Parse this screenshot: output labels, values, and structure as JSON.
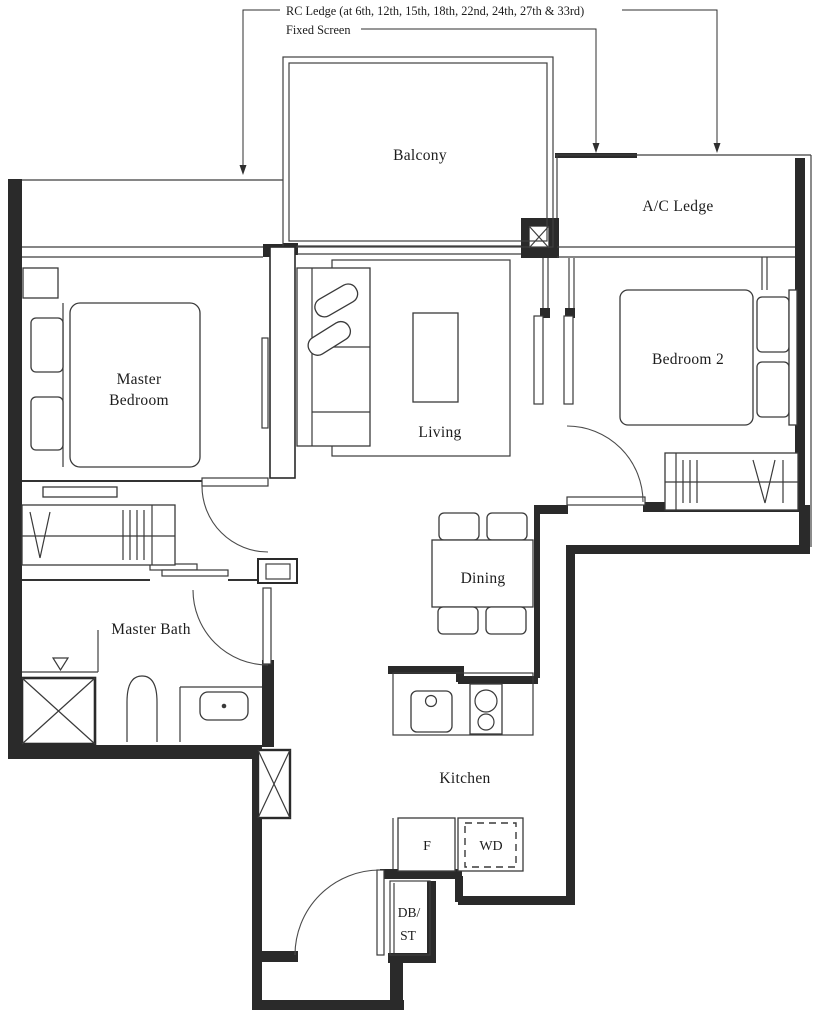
{
  "annotations": {
    "rc_ledge": "RC Ledge (at 6th, 12th, 15th, 18th, 22nd, 24th, 27th & 33rd)",
    "fixed_screen": "Fixed Screen"
  },
  "rooms": {
    "balcony": "Balcony",
    "ac_ledge": "A/C Ledge",
    "master_bedroom_line1": "Master",
    "master_bedroom_line2": "Bedroom",
    "living": "Living",
    "bedroom2": "Bedroom 2",
    "dining": "Dining",
    "master_bath": "Master Bath",
    "kitchen": "Kitchen"
  },
  "fixtures": {
    "fridge": "F",
    "washer_dryer": "WD",
    "db_st_line1": "DB/",
    "db_st_line2": "ST"
  },
  "colors": {
    "line": "#2a2a2a",
    "bg": "#ffffff"
  }
}
